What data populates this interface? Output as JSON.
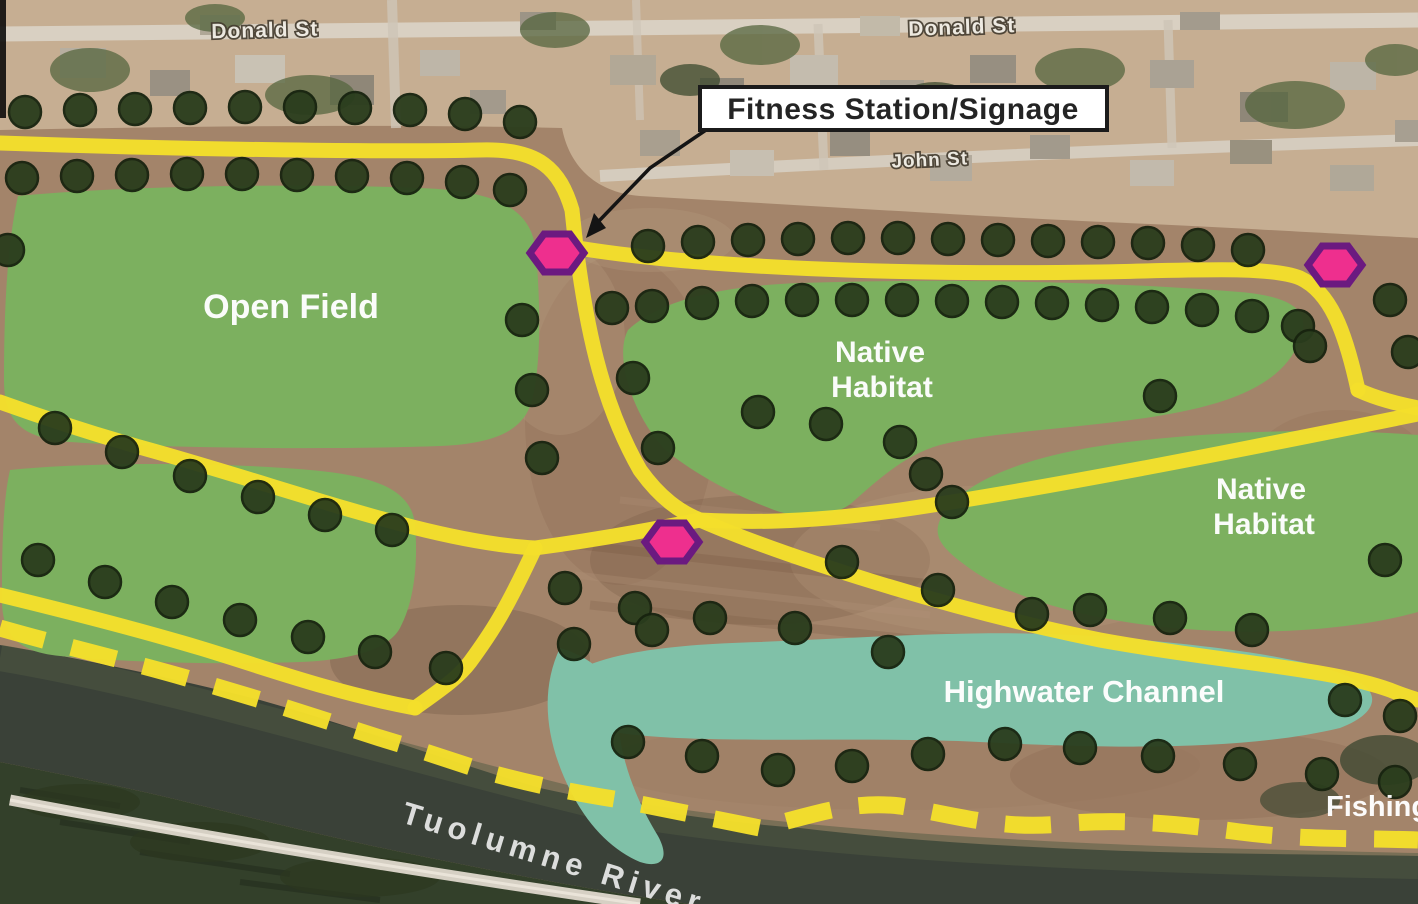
{
  "map": {
    "callout": {
      "label": "Fitness Station/Signage"
    },
    "streets": [
      {
        "name": "donald-st-west",
        "text": "Donald St"
      },
      {
        "name": "donald-st-east",
        "text": "Donald St"
      },
      {
        "name": "john-st",
        "text": "John St"
      }
    ],
    "areas": {
      "open_field": {
        "label": "Open Field"
      },
      "native_habitat_center": {
        "line1": "Native",
        "line2": "Habitat"
      },
      "native_habitat_east": {
        "line1": "Native",
        "line2": "Habitat"
      },
      "highwater_channel": {
        "label": "Highwater Channel"
      }
    },
    "river": {
      "label": "Tuolumne River"
    },
    "shore": {
      "label": "Fishing"
    },
    "markers": {
      "fitness_stations": [
        {
          "x": 557,
          "y": 253
        },
        {
          "x": 1335,
          "y": 265
        },
        {
          "x": 672,
          "y": 542
        }
      ]
    },
    "trees": [
      [
        25,
        112
      ],
      [
        80,
        110
      ],
      [
        135,
        109
      ],
      [
        190,
        108
      ],
      [
        245,
        107
      ],
      [
        300,
        107
      ],
      [
        355,
        108
      ],
      [
        410,
        110
      ],
      [
        465,
        114
      ],
      [
        520,
        122
      ],
      [
        22,
        178
      ],
      [
        77,
        176
      ],
      [
        132,
        175
      ],
      [
        187,
        174
      ],
      [
        242,
        174
      ],
      [
        297,
        175
      ],
      [
        352,
        176
      ],
      [
        407,
        178
      ],
      [
        462,
        182
      ],
      [
        510,
        190
      ],
      [
        8,
        250
      ],
      [
        522,
        320
      ],
      [
        532,
        390
      ],
      [
        542,
        458
      ],
      [
        612,
        308
      ],
      [
        633,
        378
      ],
      [
        658,
        448
      ],
      [
        648,
        246
      ],
      [
        698,
        242
      ],
      [
        748,
        240
      ],
      [
        798,
        239
      ],
      [
        848,
        238
      ],
      [
        898,
        238
      ],
      [
        948,
        239
      ],
      [
        998,
        240
      ],
      [
        1048,
        241
      ],
      [
        1098,
        242
      ],
      [
        1148,
        243
      ],
      [
        1198,
        245
      ],
      [
        1248,
        250
      ],
      [
        652,
        306
      ],
      [
        702,
        303
      ],
      [
        752,
        301
      ],
      [
        802,
        300
      ],
      [
        852,
        300
      ],
      [
        902,
        300
      ],
      [
        952,
        301
      ],
      [
        1002,
        302
      ],
      [
        1052,
        303
      ],
      [
        1102,
        305
      ],
      [
        1152,
        307
      ],
      [
        1202,
        310
      ],
      [
        1252,
        316
      ],
      [
        1298,
        326
      ],
      [
        1390,
        300
      ],
      [
        1408,
        352
      ],
      [
        55,
        428
      ],
      [
        122,
        452
      ],
      [
        190,
        476
      ],
      [
        258,
        497
      ],
      [
        325,
        515
      ],
      [
        392,
        530
      ],
      [
        38,
        560
      ],
      [
        105,
        582
      ],
      [
        172,
        602
      ],
      [
        240,
        620
      ],
      [
        308,
        637
      ],
      [
        375,
        652
      ],
      [
        446,
        668
      ],
      [
        565,
        588
      ],
      [
        635,
        608
      ],
      [
        842,
        562
      ],
      [
        938,
        590
      ],
      [
        1032,
        614
      ],
      [
        795,
        628
      ],
      [
        888,
        652
      ],
      [
        574,
        644
      ],
      [
        652,
        630
      ],
      [
        710,
        618
      ],
      [
        1090,
        610
      ],
      [
        1170,
        618
      ],
      [
        1252,
        630
      ],
      [
        1345,
        700
      ],
      [
        1400,
        716
      ],
      [
        628,
        742
      ],
      [
        702,
        756
      ],
      [
        778,
        770
      ],
      [
        852,
        766
      ],
      [
        928,
        754
      ],
      [
        1005,
        744
      ],
      [
        1080,
        748
      ],
      [
        1158,
        756
      ],
      [
        1240,
        764
      ],
      [
        1322,
        774
      ],
      [
        1395,
        782
      ],
      [
        758,
        412
      ],
      [
        826,
        424
      ],
      [
        900,
        442
      ],
      [
        926,
        474
      ],
      [
        952,
        502
      ],
      [
        1160,
        396
      ],
      [
        1310,
        346
      ],
      [
        1385,
        560
      ]
    ],
    "colors": {
      "trail": "#f4df2b",
      "tree": "#2a3d1d",
      "tree_edge": "#17230f",
      "field": "#7cb05f",
      "channel": "#80c1a8",
      "river": "#3a4138",
      "marker_fill": "#ee2f8e",
      "marker_border": "#6b1a80",
      "label_text": "#ffffff",
      "callout_border": "#1b1b1b"
    }
  }
}
